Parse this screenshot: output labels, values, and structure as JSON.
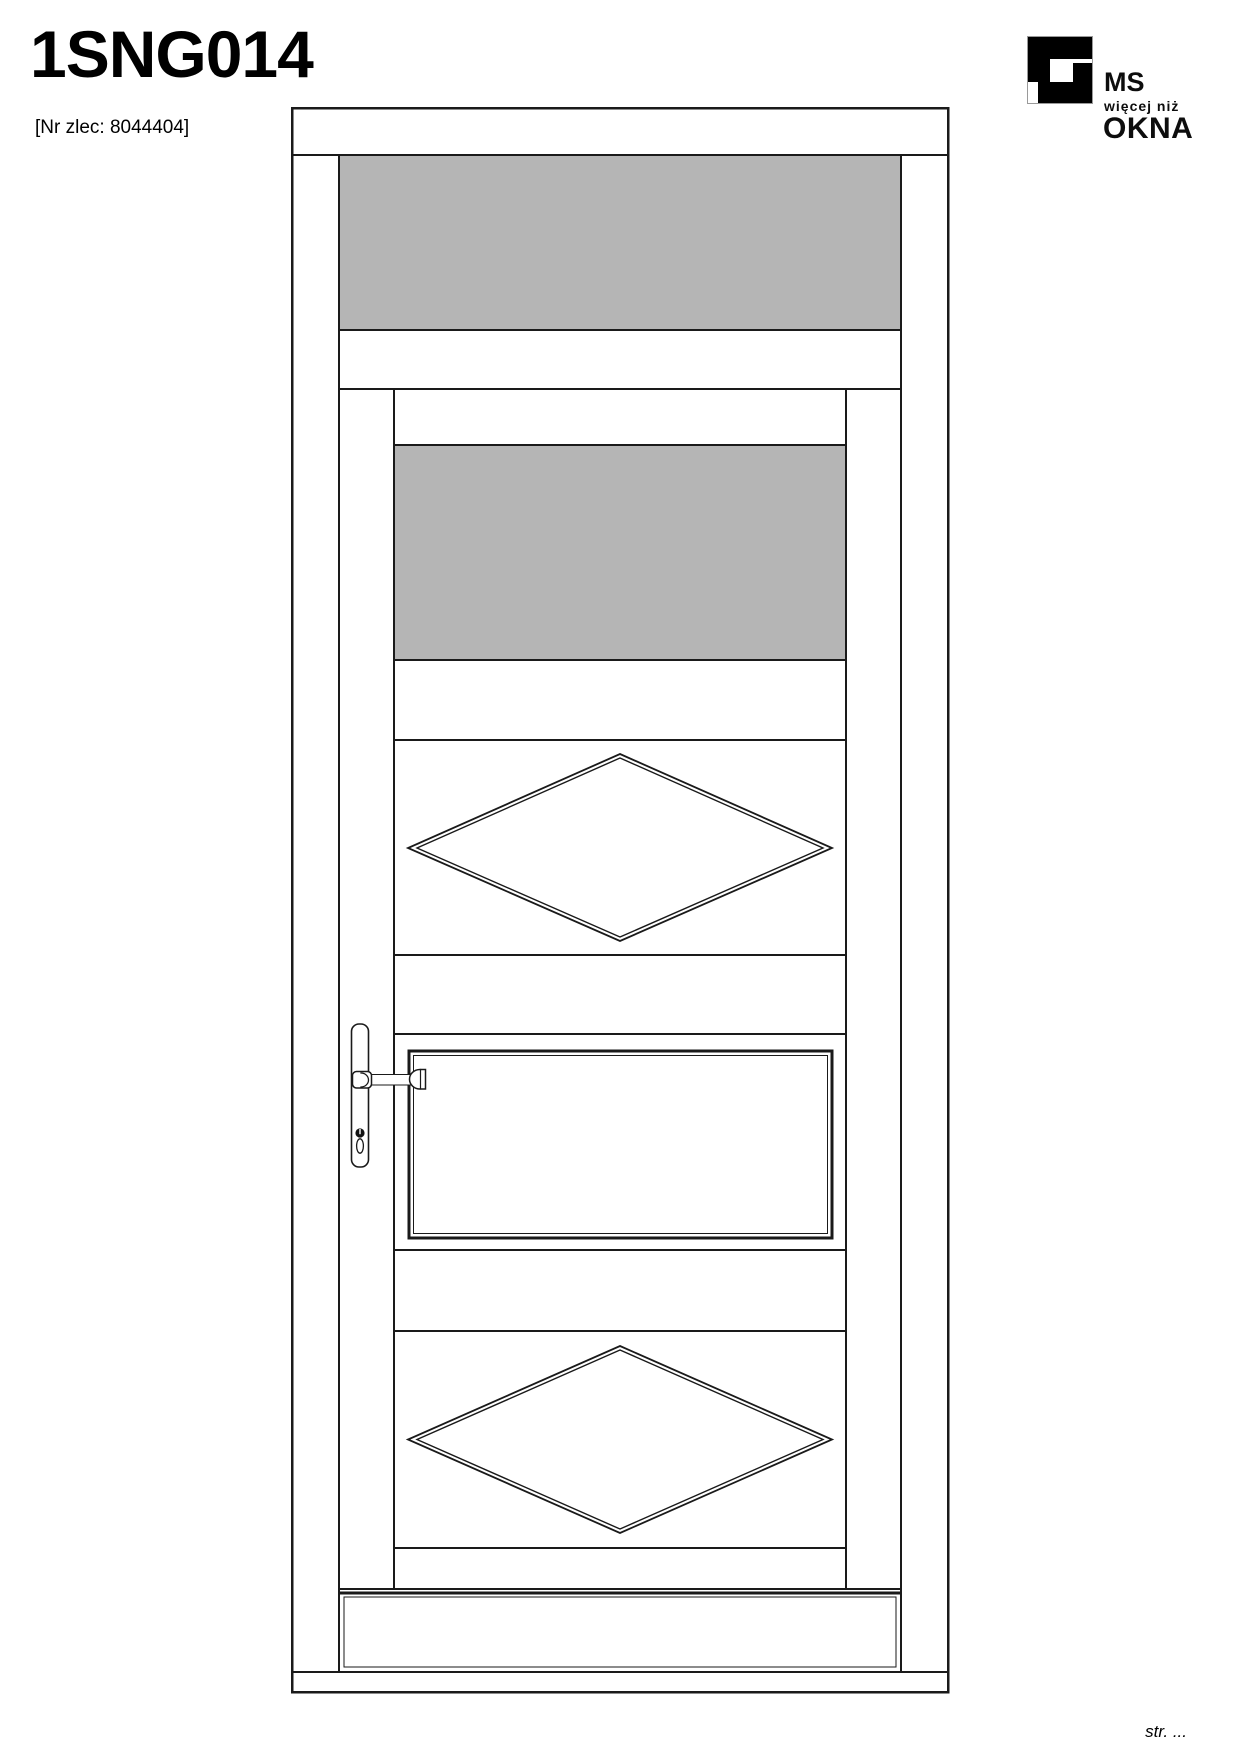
{
  "header": {
    "title": "1SNG014",
    "order_label": "[Nr zlec: 8044404]"
  },
  "logo": {
    "brand_top": "MS",
    "brand_middle": "więcej niż",
    "brand_bottom": "OKNA"
  },
  "footer": {
    "page_label": "str. ..."
  },
  "colors": {
    "glass": "#b5b5b5",
    "line": "#1a1a1a"
  }
}
